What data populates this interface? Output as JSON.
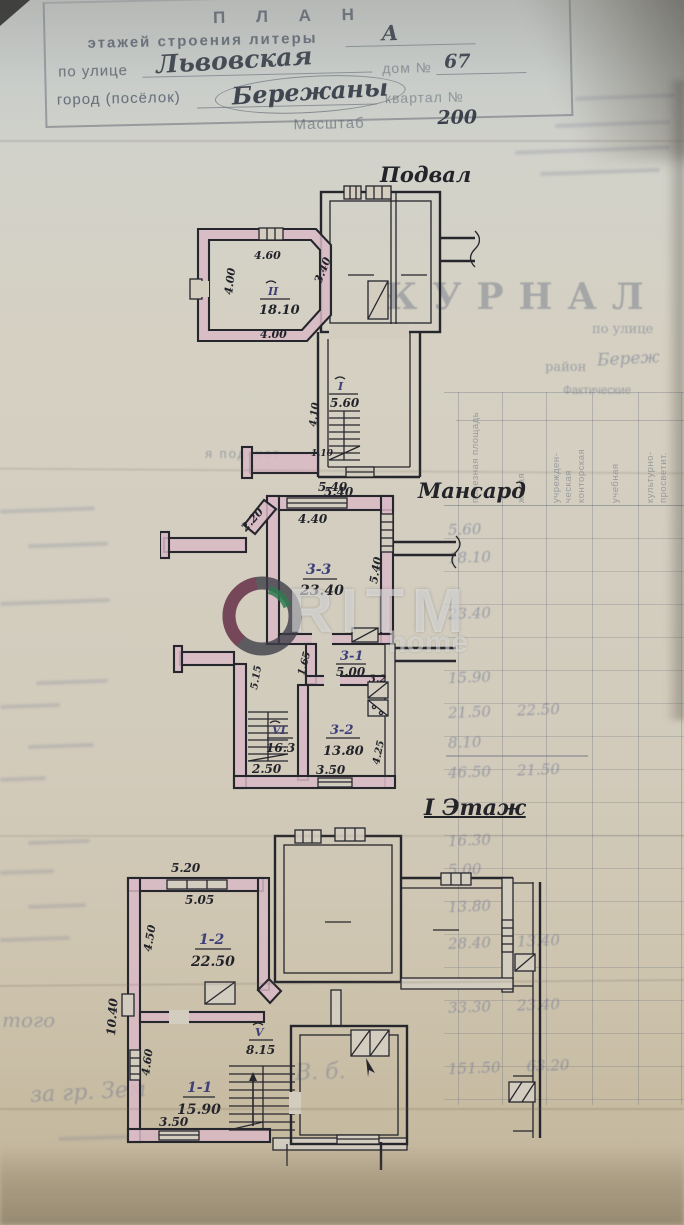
{
  "header": {
    "title": "П Л А Н",
    "l2_pre": "этажей строения литеры",
    "l2_val": "А",
    "l3_pre": "по улице",
    "l3_val": "Львовская",
    "l3_post": "дом №",
    "l3_num": "67",
    "l4_pre": "город (посёлок)",
    "l4_val": "Бережаны",
    "l4_post": "квартал №",
    "l5_pre": "Масштаб",
    "l5_val": "200"
  },
  "bleed": {
    "journal": "ЖУРНАЛ",
    "po_ulice": "по улице",
    "raion": "район",
    "raion_val": "Береж",
    "fact": "Фактические",
    "note": "я подсчет",
    "itogo": "того",
    "scrib1": "за гр. Зем",
    "scrib2": "В. б.",
    "cols": [
      "полезная площадь",
      "жилая",
      "учрежден-",
      "ческая",
      "конторская",
      "учебная",
      "культурно-",
      "просветит."
    ],
    "rows": [
      {
        "a": "5.60",
        "b": ""
      },
      {
        "a": "18.10",
        "b": ""
      },
      {
        "a": "23.40",
        "b": ""
      },
      {
        "a": "15.90",
        "b": ""
      },
      {
        "a": "21.50",
        "b": "22.50"
      },
      {
        "a": "8.10",
        "b": ""
      },
      {
        "a": "46.50",
        "b": "21.50"
      },
      {
        "a": "16.30",
        "b": ""
      },
      {
        "a": "5.00",
        "b": ""
      },
      {
        "a": "13.80",
        "b": ""
      },
      {
        "a": "28.40",
        "b": "13.40"
      },
      {
        "a": "33.30",
        "b": "23.40"
      },
      {
        "a": "151.50",
        "b": "63.20"
      }
    ]
  },
  "watermark": {
    "brand": "RITM",
    "sub": "home"
  },
  "plans": {
    "basement": {
      "label": "Подвал",
      "room2": {
        "id": "II",
        "area": "18.10"
      },
      "stair": {
        "id": "I",
        "area": "5.60"
      },
      "dims": {
        "top": "4.60",
        "left": "4.00",
        "right": "3.40",
        "bottom": "4.00",
        "stair_h": "4.10",
        "stair_s": "1.10",
        "width": "5.40"
      }
    },
    "mansard": {
      "label": "Мансард",
      "r33": {
        "id": "3-3",
        "area": "23.40"
      },
      "r31": {
        "id": "3-1",
        "area": "5.00"
      },
      "r32": {
        "id": "3-2",
        "area": "13.80"
      },
      "r6": {
        "id": "VI",
        "area": "16.3"
      },
      "dims": {
        "top": "5.40",
        "inner_top": "4.40",
        "left_diag": "2.20",
        "right": "5.40",
        "d165": "1.65",
        "d515": "5.15",
        "d32": "3.2",
        "d425": "4.25",
        "d250": "2.50",
        "d350": "3.50"
      }
    },
    "floor1": {
      "label": "І Этаж",
      "r12": {
        "id": "1-2",
        "area": "22.50"
      },
      "r11": {
        "id": "1-1",
        "area": "15.90"
      },
      "r5": {
        "id": "V",
        "area": "8.15"
      },
      "dims": {
        "d520": "5.20",
        "d505": "5.05",
        "d450": "4.50",
        "d1040": "10.40",
        "d460": "4.60",
        "d350": "3.50"
      }
    }
  }
}
